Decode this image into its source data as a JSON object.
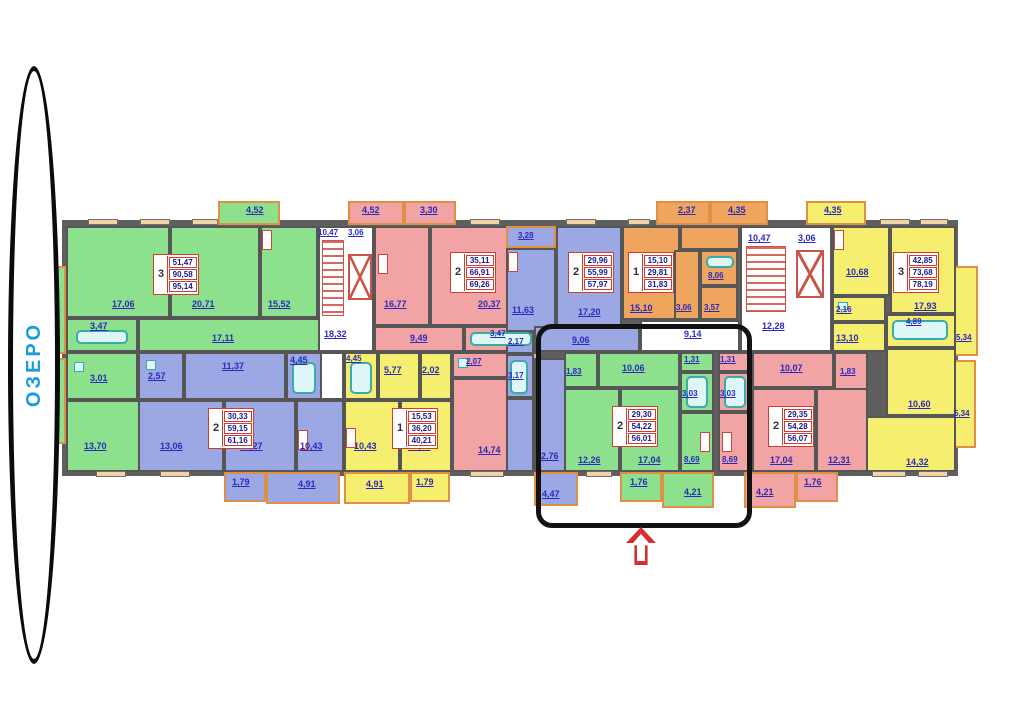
{
  "lake": {
    "label": "ОЗЕРО"
  },
  "colors": {
    "green": "#8de08c",
    "blue": "#9ba8e3",
    "pink": "#f2a3a3",
    "yellow": "#f6ee6e",
    "orange": "#f0a55e",
    "wall": "#5f5f5f",
    "label_blue": "#2a2ac0",
    "summary_red": "#d03c2e",
    "lake_blue": "#1e9cd8",
    "arrow_red": "#d42f2f"
  },
  "plan": {
    "apartments": {
      "green_left": {
        "summary": {
          "count": "3",
          "living": "51,47",
          "total": "90,58",
          "full": "95,14"
        },
        "rooms": {
          "bedroom1": "17,06",
          "living_room": "20,71",
          "kitchen": "15,52",
          "bath": "3,47",
          "hall": "17,11",
          "wc": "3,01",
          "bedroom2": "13,70"
        },
        "balconies": {
          "top": "4,52",
          "left_upper": "5,34",
          "left_lower": "5,34"
        }
      },
      "blue_left": {
        "summary": {
          "count": "2",
          "living": "30,33",
          "total": "59,15",
          "full": "61,16"
        },
        "rooms": {
          "wc": "2,57",
          "hall": "11,37",
          "bath": "4,45",
          "bedroom1": "13,06",
          "bedroom2": "17,27",
          "kitchen": "10,43"
        },
        "balconies": {
          "b1": "1,79",
          "b2": "4,91"
        }
      },
      "pink_left": {
        "summary": {
          "count": "2",
          "living": "35,11",
          "total": "66,91",
          "full": "69,26"
        },
        "rooms": {
          "kitchen": "16,77",
          "living_room": "20,37",
          "hall": "9,49",
          "bath": "3,47",
          "wc": "2,07",
          "bedroom": "14,74"
        },
        "balconies": {
          "b1": "4,52",
          "b2": "3,30"
        }
      },
      "yellow_left": {
        "summary": {
          "count": "1",
          "living": "15,53",
          "total": "36,20",
          "full": "40,21"
        },
        "rooms": {
          "bath": "4,45",
          "hall": "5,77",
          "wardrobe": "2,02",
          "kitchen": "10,43",
          "living_room": "15,53"
        },
        "balconies": {
          "b1": "4,91",
          "b2": "1,79"
        }
      },
      "blue_mid": {
        "summary": {
          "count": "2",
          "living": "29,96",
          "total": "55,99",
          "full": "57,97"
        },
        "rooms": {
          "kitchen": "11,63",
          "living_room": "17,20",
          "hall": "9,06",
          "wc": "2,17",
          "bath": "3,17",
          "bedroom": "12,76"
        },
        "balconies": {
          "top": "3,28",
          "bottom": "4,47"
        }
      },
      "orange_mid": {
        "summary": {
          "count": "1",
          "living": "15,10",
          "total": "29,81",
          "full": "31,83"
        },
        "rooms": {
          "living_room": "15,10",
          "hall": "3,06",
          "wc": "3,57",
          "kitchen": "8,06"
        },
        "balconies": {
          "b1": "2,37",
          "b2": "4,35"
        }
      },
      "green_mid": {
        "summary": {
          "count": "2",
          "living": "29,30",
          "total": "54,22",
          "full": "56,01"
        },
        "rooms": {
          "entry": "1,83",
          "hall": "10,06",
          "wc": "1,31",
          "bath": "3,03",
          "bedroom": "12,26",
          "living_room": "17,04",
          "kitchen": "8,69"
        },
        "balconies": {
          "b1": "1,76",
          "b2": "4,21"
        }
      },
      "pink_right": {
        "summary": {
          "count": "2",
          "living": "29,35",
          "total": "54,28",
          "full": "56,07"
        },
        "rooms": {
          "wc": "1,31",
          "bath": "3,03",
          "hall": "10,07",
          "entry": "1,83",
          "kitchen": "8,69",
          "living_room": "17,04",
          "bedroom": "12,31"
        },
        "balconies": {
          "b1": "4,21",
          "b2": "1,76"
        }
      },
      "yellow_right": {
        "summary": {
          "count": "3",
          "living": "42,85",
          "total": "73,68",
          "full": "78,19"
        },
        "rooms": {
          "kitchen": "10,68",
          "living_room": "17,93",
          "wc": "2,16",
          "bath": "4,89",
          "hall": "13,10",
          "bedroom1": "10,60",
          "bedroom2": "14,32"
        },
        "balconies": {
          "top": "4,35",
          "right_upper": "5,34",
          "right_lower": "5,34"
        }
      }
    },
    "stairwells": {
      "left": {
        "stairs": "10,47",
        "vestibule": "3,06",
        "corridor": "18,32"
      },
      "right": {
        "stairs": "10,47",
        "vestibule": "3,06",
        "corridor": "12,28"
      },
      "center_corridor": "9,14"
    }
  }
}
